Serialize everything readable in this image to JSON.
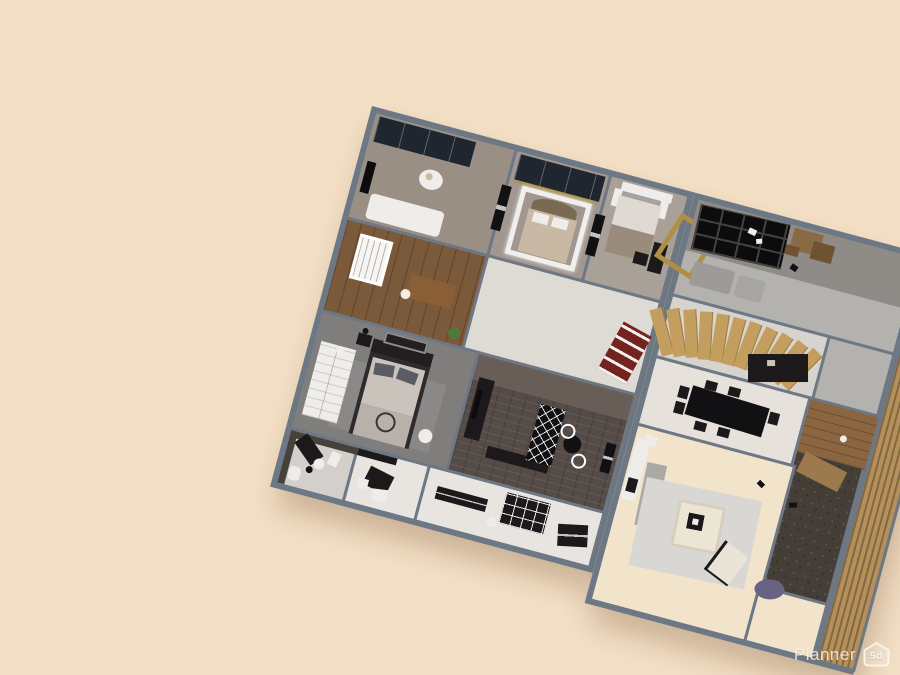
{
  "watermark": {
    "brand": "Planner",
    "logo_text": "5d",
    "logo_icon": "house-5d-icon"
  },
  "palette": {
    "bg": "#f3dfc5",
    "wall_edge": "#6d7884",
    "wall_face": "#e9ebec",
    "taupe_a": "#9a8f85",
    "taupe_b": "#a29790",
    "taupe_c": "#a9a098",
    "nursery_wood": "#7b5a3b",
    "hall_floor": "#dedad4",
    "master_floor": "#7f7e7c",
    "brick_floor": "#564c47",
    "brick_band": "#6c625a",
    "bath_floor": "#d3d0cc",
    "white_floor": "#e8e5e0",
    "conc_dark": "#8f8c88",
    "conc_light": "#b4b2ae",
    "stairhall_floor": "#d7d4cf",
    "dining_floor": "#e6e2db",
    "living_floor": "#f2e4cb",
    "pebble": "#453e37",
    "deck": "#8a6540",
    "deck_light": "#9c7a4e",
    "slat": "#b5905a",
    "slat_stripe": "#8f6c3e",
    "step": "#c49e5e",
    "navy": "#20262f",
    "black": "#111113",
    "dark": "#1d191b",
    "tv": "#0c0c0e",
    "white": "#efedea",
    "mattress": "#cac3bc",
    "blanket": "#b8b1ab",
    "bed_frame": "#2f2a2b",
    "headboard": "#231e1f",
    "pillow": "#595c62",
    "bed_tan": "#c9b9a4",
    "headboard_tan": "#7a6a52",
    "gold": "#ac9349",
    "gold_frame": "#b08f45",
    "maroon": "#73241e",
    "crib": "#f6f5f3",
    "plant": "#4e7a3a",
    "desk_wood": "#8a5f36",
    "sofa": "#9c9b99",
    "sofa2": "#a6a5a3",
    "rug": "#d9d7d3",
    "rug_gray": "#aba9a5",
    "frame_cream": "#ece5d4",
    "chair_cream": "#e9e4d6",
    "purple": "#696383",
    "wood_block": "#8a6a45",
    "wood_dark": "#6e5232",
    "blanket_c": "#9b8b7d",
    "dark_wall": "#47413c",
    "bed_white": "#ded9d2",
    "gray_blanket": "#9aa0a6"
  },
  "rooms": [
    {
      "id": "bedroom-1",
      "floor": "#9a8f85"
    },
    {
      "id": "bedroom-2-canopy",
      "floor": "#a29790"
    },
    {
      "id": "bedroom-3",
      "floor": "#a9a098"
    },
    {
      "id": "nursery",
      "floor": "#7b5a3b"
    },
    {
      "id": "hallway",
      "floor": "#dedad4"
    },
    {
      "id": "master-bedroom",
      "floor": "#7f7e7c"
    },
    {
      "id": "brick-media-room",
      "floor": "#564c47"
    },
    {
      "id": "bathroom",
      "floor": "#d3d0cc"
    },
    {
      "id": "mudroom",
      "floor": "#e8e5e0"
    },
    {
      "id": "office",
      "floor": "#e8e5e0"
    },
    {
      "id": "lounge",
      "floor": "#b4b2ae"
    },
    {
      "id": "stair-hall",
      "floor": "#d7d4cf"
    },
    {
      "id": "dining-area",
      "floor": "#e6e2db"
    },
    {
      "id": "stone-bath",
      "floor": "#453e37"
    },
    {
      "id": "living-room",
      "floor": "#f2e4cb"
    }
  ]
}
